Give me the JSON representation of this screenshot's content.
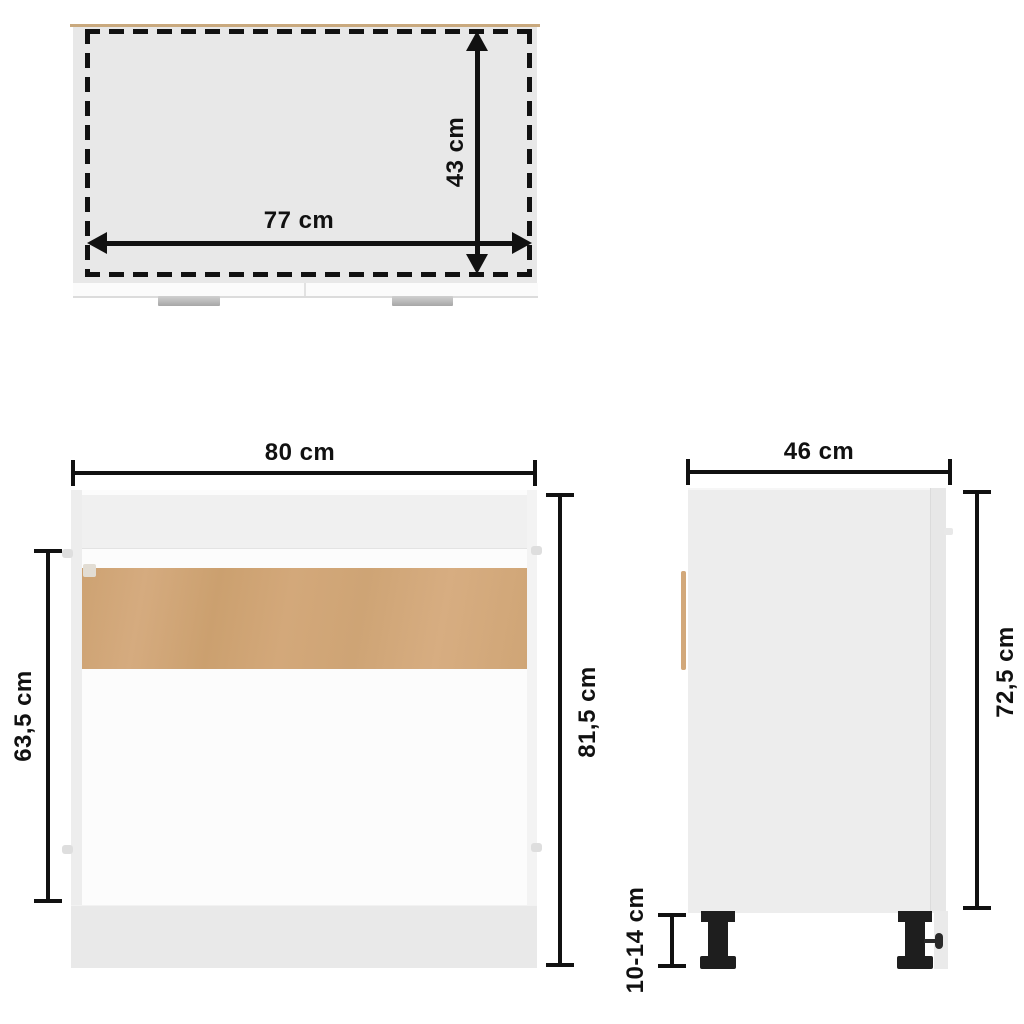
{
  "diagram": {
    "views": {
      "top": {
        "width_dim": "77 cm",
        "depth_dim": "43 cm"
      },
      "front": {
        "width_dim": "80 cm",
        "total_height_dim": "81,5 cm",
        "inner_height_dim": "63,5 cm"
      },
      "side": {
        "depth_dim": "46 cm",
        "body_height_dim": "72,5 cm",
        "leg_height_dim": "10-14 cm"
      }
    },
    "colors": {
      "dimension_line": "#111111",
      "cabinet_white": "#fcfcfc",
      "surface_gray": "#e8e8e8",
      "panel_gray": "#f0f0f0",
      "wood_tan": "#d0a679",
      "handle_gray": "#b5b5b5",
      "leg_black": "#1e1e1e"
    }
  }
}
